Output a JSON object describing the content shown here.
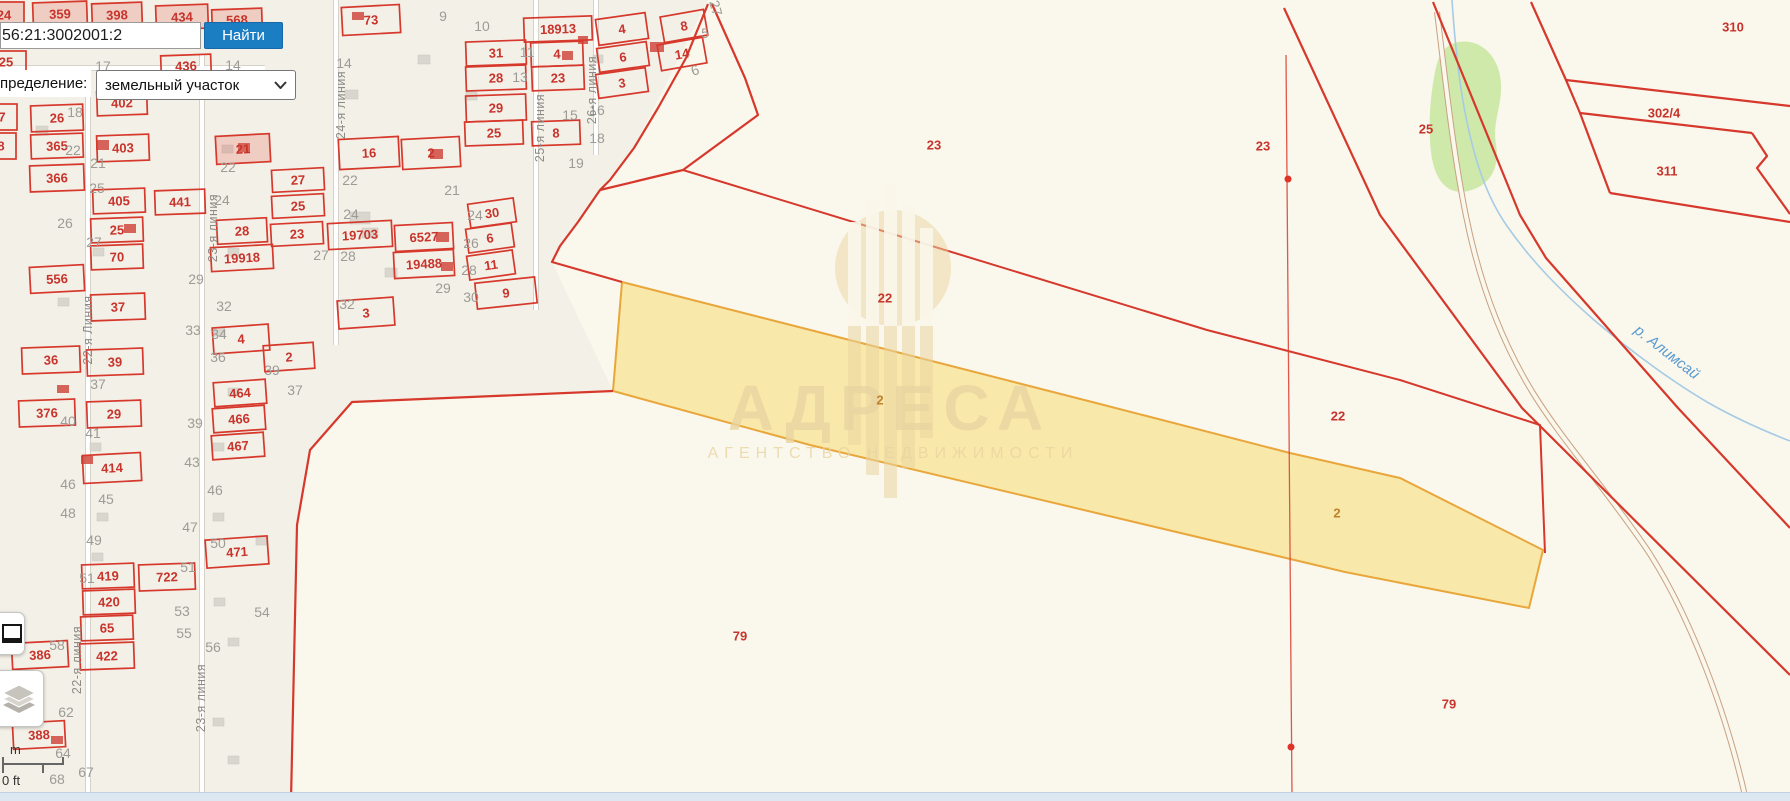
{
  "colors": {
    "map_red": "#d6382c",
    "label_red": "#c8342c",
    "gray_num": "#9d9b96",
    "street_gray": "#8c8a86",
    "yellow_fill": "#f7e082",
    "yellow_stroke": "#e9a63b",
    "green": "#cfe9ab",
    "river": "#a6cbe6",
    "river_label": "#5b9bd0",
    "tan": "#e9d5a0",
    "button_blue": "#1b7ec2",
    "bottom_bar": "#dce7f2",
    "urban_bg": "#f3f0e7",
    "page_bg": "#faf7ec",
    "yellow_label": "#c2802a",
    "building_gray": "#d9d6ce",
    "building_red": "#cf4a40"
  },
  "search": {
    "value": "56:21:3002001:2",
    "button_label": "Найти"
  },
  "filter": {
    "label": "пределение:",
    "value": "земельный участок"
  },
  "watermark": {
    "title": "АДРЕСА",
    "subtitle": "АГЕНТСТВО НЕДВИЖИМОСТИ"
  },
  "river": {
    "label": "р. Алимсай"
  },
  "scale": {
    "m_label": "m",
    "ft_label": "0 ft"
  },
  "map": {
    "red_parcels": {
      "fields": [
        "label",
        "cx",
        "cy",
        "w",
        "h",
        "rot",
        "tint"
      ],
      "rows": [
        [
          "24",
          4,
          15,
          40,
          26,
          0,
          1
        ],
        [
          "359",
          60,
          14,
          54,
          24,
          -2,
          1
        ],
        [
          "398",
          117,
          15,
          50,
          24,
          -2,
          1
        ],
        [
          "434",
          182,
          17,
          52,
          24,
          -2,
          1
        ],
        [
          "568",
          237,
          20,
          50,
          22,
          -2,
          1
        ],
        [
          "73",
          371,
          20,
          58,
          28,
          -3,
          0
        ],
        [
          "18913",
          558,
          29,
          68,
          24,
          -2,
          0
        ],
        [
          "31",
          496,
          53,
          60,
          24,
          -2,
          0
        ],
        [
          "4",
          557,
          54,
          52,
          24,
          -2,
          0
        ],
        [
          "28",
          496,
          78,
          60,
          24,
          -2,
          0
        ],
        [
          "23",
          558,
          78,
          52,
          24,
          -2,
          0
        ],
        [
          "29",
          496,
          108,
          60,
          26,
          -2,
          0
        ],
        [
          "25",
          494,
          133,
          58,
          24,
          -2,
          0
        ],
        [
          "8",
          556,
          133,
          48,
          24,
          -2,
          0
        ],
        [
          "4",
          622,
          29,
          50,
          26,
          -8,
          0
        ],
        [
          "6",
          623,
          57,
          50,
          24,
          -8,
          0
        ],
        [
          "3",
          622,
          83,
          50,
          24,
          -8,
          0
        ],
        [
          "8",
          684,
          26,
          44,
          26,
          -10,
          0
        ],
        [
          "14",
          682,
          54,
          46,
          26,
          -10,
          0
        ],
        [
          "436",
          186,
          66,
          50,
          22,
          -2,
          0
        ],
        [
          "25",
          6,
          62,
          40,
          22,
          0,
          0
        ],
        [
          "26",
          57,
          118,
          52,
          26,
          -2,
          0
        ],
        [
          "365",
          57,
          146,
          52,
          24,
          -2,
          0
        ],
        [
          "366",
          57,
          178,
          54,
          26,
          -2,
          0
        ],
        [
          "402",
          122,
          103,
          50,
          24,
          -2,
          0
        ],
        [
          "403",
          123,
          148,
          52,
          26,
          -2,
          0
        ],
        [
          "7",
          2,
          117,
          30,
          26,
          0,
          0
        ],
        [
          "8",
          1,
          146,
          30,
          26,
          0,
          0
        ],
        [
          "21",
          243,
          149,
          54,
          28,
          -3,
          1
        ],
        [
          "16",
          369,
          153,
          60,
          30,
          -3,
          0
        ],
        [
          "2",
          431,
          153,
          58,
          30,
          -3,
          0
        ],
        [
          "27",
          298,
          180,
          52,
          22,
          -3,
          0
        ],
        [
          "25",
          298,
          206,
          52,
          22,
          -3,
          0
        ],
        [
          "23",
          297,
          234,
          52,
          22,
          -3,
          0
        ],
        [
          "19703",
          360,
          235,
          64,
          26,
          -3,
          0
        ],
        [
          "6527",
          424,
          237,
          58,
          26,
          -3,
          0
        ],
        [
          "19488",
          424,
          264,
          60,
          26,
          -3,
          0
        ],
        [
          "3",
          366,
          313,
          56,
          28,
          -4,
          0
        ],
        [
          "30",
          492,
          213,
          46,
          24,
          -8,
          0
        ],
        [
          "6",
          490,
          238,
          46,
          24,
          -8,
          0
        ],
        [
          "11",
          491,
          265,
          46,
          24,
          -8,
          0
        ],
        [
          "9",
          506,
          293,
          60,
          26,
          -6,
          0
        ],
        [
          "405",
          119,
          201,
          52,
          24,
          -2,
          0
        ],
        [
          "441",
          180,
          202,
          50,
          24,
          -2,
          0
        ],
        [
          "25",
          117,
          230,
          52,
          24,
          -2,
          0
        ],
        [
          "70",
          117,
          257,
          52,
          24,
          -2,
          0
        ],
        [
          "28",
          242,
          231,
          50,
          24,
          -3,
          0
        ],
        [
          "19918",
          242,
          258,
          62,
          24,
          -3,
          0
        ],
        [
          "556",
          57,
          279,
          54,
          26,
          -3,
          0
        ],
        [
          "37",
          118,
          307,
          54,
          26,
          -2,
          0
        ],
        [
          "36",
          51,
          360,
          58,
          26,
          -2,
          0
        ],
        [
          "39",
          115,
          362,
          56,
          26,
          -2,
          0
        ],
        [
          "376",
          47,
          413,
          56,
          26,
          -2,
          0
        ],
        [
          "29",
          114,
          414,
          54,
          26,
          -2,
          0
        ],
        [
          "414",
          112,
          468,
          58,
          28,
          -3,
          0
        ],
        [
          "4",
          241,
          339,
          56,
          26,
          -4,
          0
        ],
        [
          "2",
          289,
          357,
          50,
          26,
          -4,
          0
        ],
        [
          "464",
          240,
          393,
          52,
          24,
          -4,
          0
        ],
        [
          "466",
          239,
          419,
          52,
          24,
          -4,
          0
        ],
        [
          "467",
          238,
          446,
          52,
          24,
          -4,
          0
        ],
        [
          "419",
          108,
          576,
          52,
          24,
          -2,
          0
        ],
        [
          "722",
          167,
          577,
          56,
          26,
          -2,
          0
        ],
        [
          "420",
          109,
          602,
          52,
          24,
          -2,
          0
        ],
        [
          "65",
          107,
          628,
          52,
          24,
          -2,
          0
        ],
        [
          "422",
          107,
          656,
          54,
          26,
          -2,
          0
        ],
        [
          "386",
          40,
          655,
          56,
          26,
          -3,
          0
        ],
        [
          "388",
          39,
          735,
          52,
          26,
          -3,
          0
        ],
        [
          "471",
          237,
          552,
          62,
          28,
          -4,
          0
        ]
      ]
    },
    "rural_labels": {
      "fields": [
        "label",
        "cx",
        "cy"
      ],
      "rows": [
        [
          "23",
          934,
          145
        ],
        [
          "23",
          1263,
          146
        ],
        [
          "25",
          1426,
          129
        ],
        [
          "310",
          1733,
          27
        ],
        [
          "302/4",
          1664,
          113
        ],
        [
          "311",
          1667,
          171
        ],
        [
          "22",
          885,
          298
        ],
        [
          "22",
          1338,
          416
        ],
        [
          "79",
          740,
          636
        ],
        [
          "79",
          1449,
          704
        ]
      ]
    },
    "yellow_labels": {
      "fields": [
        "label",
        "cx",
        "cy"
      ],
      "rows": [
        [
          "2",
          880,
          400
        ],
        [
          "2",
          1337,
          513
        ]
      ]
    },
    "gray_numbers": {
      "fields": [
        "label",
        "cx",
        "cy",
        "rot"
      ],
      "rows": [
        [
          "9",
          443,
          16,
          0
        ],
        [
          "10",
          482,
          26,
          0
        ],
        [
          "11",
          527,
          52,
          0
        ],
        [
          "13",
          520,
          77,
          0
        ],
        [
          "14",
          344,
          63,
          0
        ],
        [
          "15",
          570,
          115,
          0
        ],
        [
          "16",
          597,
          110,
          0
        ],
        [
          "17",
          103,
          66,
          0
        ],
        [
          "14",
          233,
          65,
          0
        ],
        [
          "18",
          218,
          40,
          0
        ],
        [
          "18",
          75,
          112,
          0
        ],
        [
          "18",
          597,
          138,
          0
        ],
        [
          "19",
          576,
          163,
          0
        ],
        [
          "22",
          73,
          150,
          0
        ],
        [
          "21",
          98,
          163,
          0
        ],
        [
          "22",
          228,
          167,
          0
        ],
        [
          "25",
          97,
          188,
          0
        ],
        [
          "26",
          65,
          223,
          0
        ],
        [
          "27",
          94,
          242,
          0
        ],
        [
          "24",
          222,
          200,
          0
        ],
        [
          "21",
          452,
          190,
          0
        ],
        [
          "22",
          350,
          180,
          0
        ],
        [
          "24",
          475,
          215,
          0
        ],
        [
          "24",
          351,
          214,
          0
        ],
        [
          "26",
          471,
          243,
          0
        ],
        [
          "27",
          321,
          255,
          0
        ],
        [
          "28",
          348,
          256,
          0
        ],
        [
          "28",
          469,
          270,
          0
        ],
        [
          "29",
          443,
          288,
          0
        ],
        [
          "30",
          471,
          297,
          0
        ],
        [
          "32",
          347,
          304,
          0
        ],
        [
          "29",
          196,
          279,
          0
        ],
        [
          "32",
          224,
          306,
          0
        ],
        [
          "33",
          193,
          330,
          0
        ],
        [
          "34",
          219,
          334,
          0
        ],
        [
          "36",
          218,
          357,
          0
        ],
        [
          "37",
          98,
          384,
          0
        ],
        [
          "37",
          295,
          390,
          0
        ],
        [
          "39",
          272,
          370,
          0
        ],
        [
          "39",
          195,
          423,
          0
        ],
        [
          "40",
          68,
          421,
          0
        ],
        [
          "41",
          93,
          433,
          0
        ],
        [
          "43",
          192,
          462,
          0
        ],
        [
          "45",
          106,
          499,
          0
        ],
        [
          "46",
          68,
          484,
          0
        ],
        [
          "46",
          215,
          490,
          0
        ],
        [
          "47",
          190,
          527,
          0
        ],
        [
          "48",
          68,
          513,
          0
        ],
        [
          "49",
          94,
          540,
          0
        ],
        [
          "50",
          218,
          543,
          0
        ],
        [
          "51",
          87,
          578,
          0
        ],
        [
          "51",
          188,
          567,
          0
        ],
        [
          "53",
          182,
          611,
          0
        ],
        [
          "54",
          262,
          612,
          0
        ],
        [
          "55",
          184,
          633,
          0
        ],
        [
          "56",
          213,
          647,
          0
        ],
        [
          "58",
          57,
          645,
          0
        ],
        [
          "62",
          66,
          712,
          0
        ],
        [
          "64",
          63,
          753,
          0
        ],
        [
          "67",
          86,
          772,
          0
        ],
        [
          "68",
          57,
          779,
          0
        ],
        [
          "5",
          705,
          33,
          0
        ],
        [
          "6",
          695,
          70,
          -20
        ],
        [
          "27",
          716,
          8,
          75
        ]
      ]
    },
    "streets": {
      "fields": [
        "label",
        "cx",
        "cy",
        "rot"
      ],
      "rows": [
        [
          "22-я Линия",
          88,
          330,
          -90
        ],
        [
          "23-я линия",
          213,
          228,
          -90
        ],
        [
          "24-я линия",
          341,
          105,
          -90
        ],
        [
          "25-я линия",
          540,
          128,
          -90
        ],
        [
          "26-я линия",
          592,
          90,
          -90
        ],
        [
          "22-я линия",
          77,
          660,
          -90
        ],
        [
          "23-я линия",
          201,
          698,
          -90
        ]
      ]
    },
    "buildings_gray": {
      "fields": [
        "x",
        "y",
        "w",
        "h"
      ],
      "rows": [
        [
          36,
          126,
          12,
          9
        ],
        [
          222,
          145,
          11,
          8
        ],
        [
          172,
          90,
          12,
          9
        ],
        [
          345,
          90,
          13,
          9
        ],
        [
          418,
          55,
          12,
          9
        ],
        [
          466,
          92,
          11,
          8
        ],
        [
          350,
          212,
          20,
          12
        ],
        [
          362,
          228,
          16,
          10
        ],
        [
          228,
          248,
          11,
          8
        ],
        [
          93,
          248,
          11,
          8
        ],
        [
          58,
          298,
          11,
          8
        ],
        [
          214,
          328,
          11,
          8
        ],
        [
          228,
          388,
          11,
          8
        ],
        [
          90,
          443,
          11,
          8
        ],
        [
          213,
          443,
          11,
          8
        ],
        [
          97,
          513,
          11,
          8
        ],
        [
          213,
          513,
          11,
          8
        ],
        [
          256,
          536,
          12,
          9
        ],
        [
          92,
          553,
          11,
          8
        ],
        [
          214,
          598,
          11,
          8
        ],
        [
          228,
          638,
          11,
          8
        ],
        [
          213,
          718,
          11,
          8
        ],
        [
          228,
          756,
          11,
          8
        ],
        [
          385,
          268,
          12,
          9
        ],
        [
          593,
          55,
          10,
          8
        ]
      ]
    },
    "buildings_red": {
      "fields": [
        "x",
        "y",
        "w",
        "h"
      ],
      "rows": [
        [
          352,
          12,
          12,
          8
        ],
        [
          578,
          36,
          10,
          8
        ],
        [
          562,
          51,
          11,
          9
        ],
        [
          650,
          42,
          14,
          10
        ],
        [
          96,
          140,
          13,
          10
        ],
        [
          430,
          149,
          13,
          10
        ],
        [
          436,
          232,
          13,
          10
        ],
        [
          441,
          262,
          12,
          9
        ],
        [
          124,
          224,
          12,
          9
        ],
        [
          57,
          385,
          12,
          8
        ],
        [
          81,
          456,
          12,
          8
        ],
        [
          51,
          736,
          12,
          8
        ],
        [
          238,
          143,
          12,
          9
        ]
      ]
    }
  }
}
